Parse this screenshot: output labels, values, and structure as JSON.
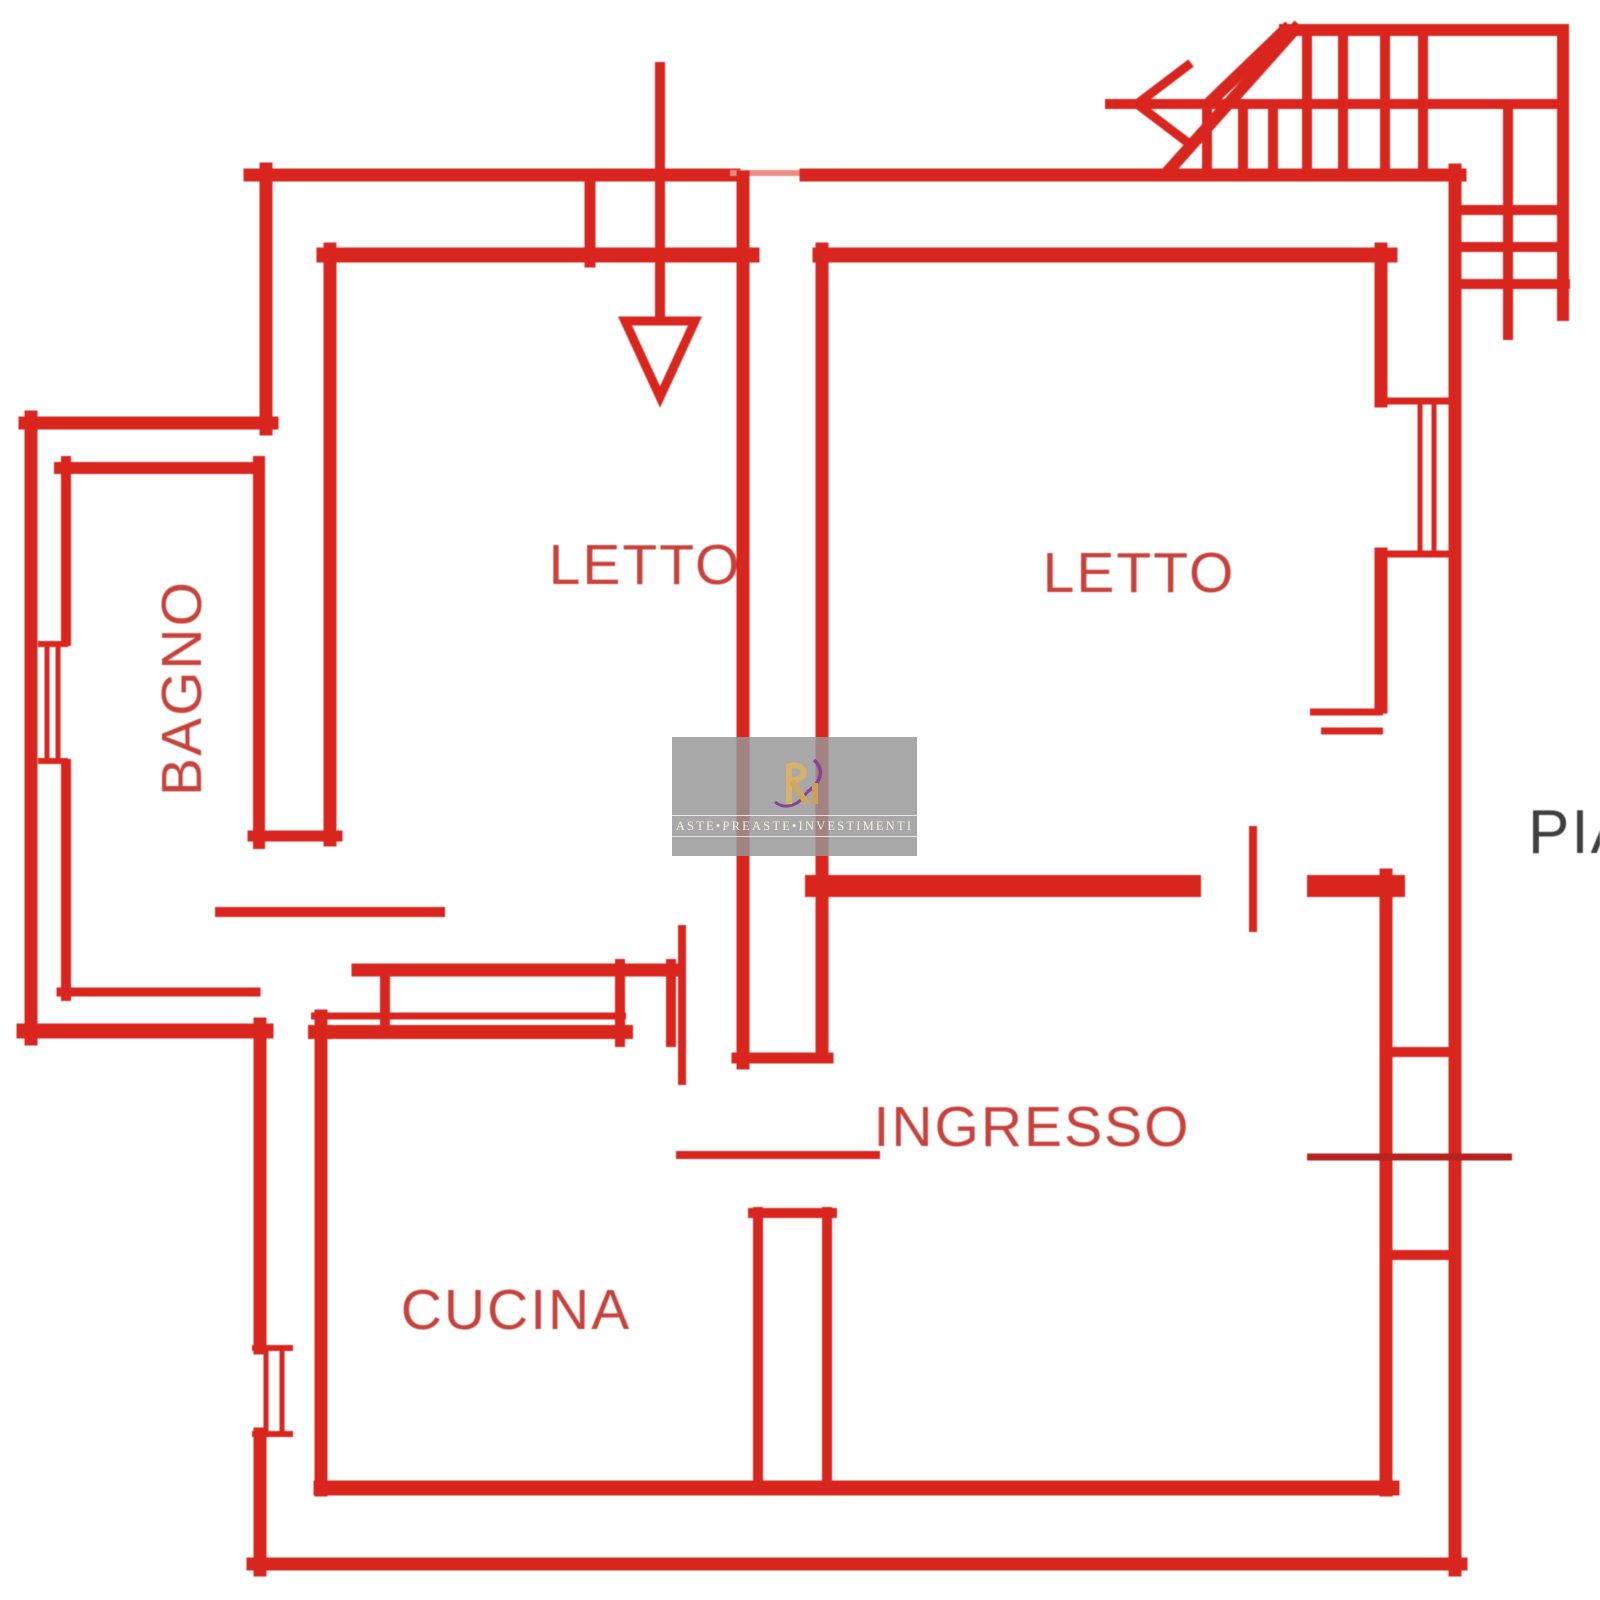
{
  "plan": {
    "rooms": {
      "bagno": "BAGNO",
      "letto_left": "LETTO",
      "letto_right": "LETTO",
      "ingresso": "INGRESSO",
      "cucina": "CUCINA"
    },
    "floor_label": "PIA",
    "watermark": {
      "text": "ASTE•PREASTE•INVESTIMENTI"
    },
    "colors": {
      "wall_red": "#d8261f",
      "label_red": "#c8423c",
      "floor_label_gray": "#3f3f3f",
      "watermark_gray": "#969696",
      "watermark_gold": "#d9b26a",
      "watermark_purple": "#8a3a96"
    }
  }
}
